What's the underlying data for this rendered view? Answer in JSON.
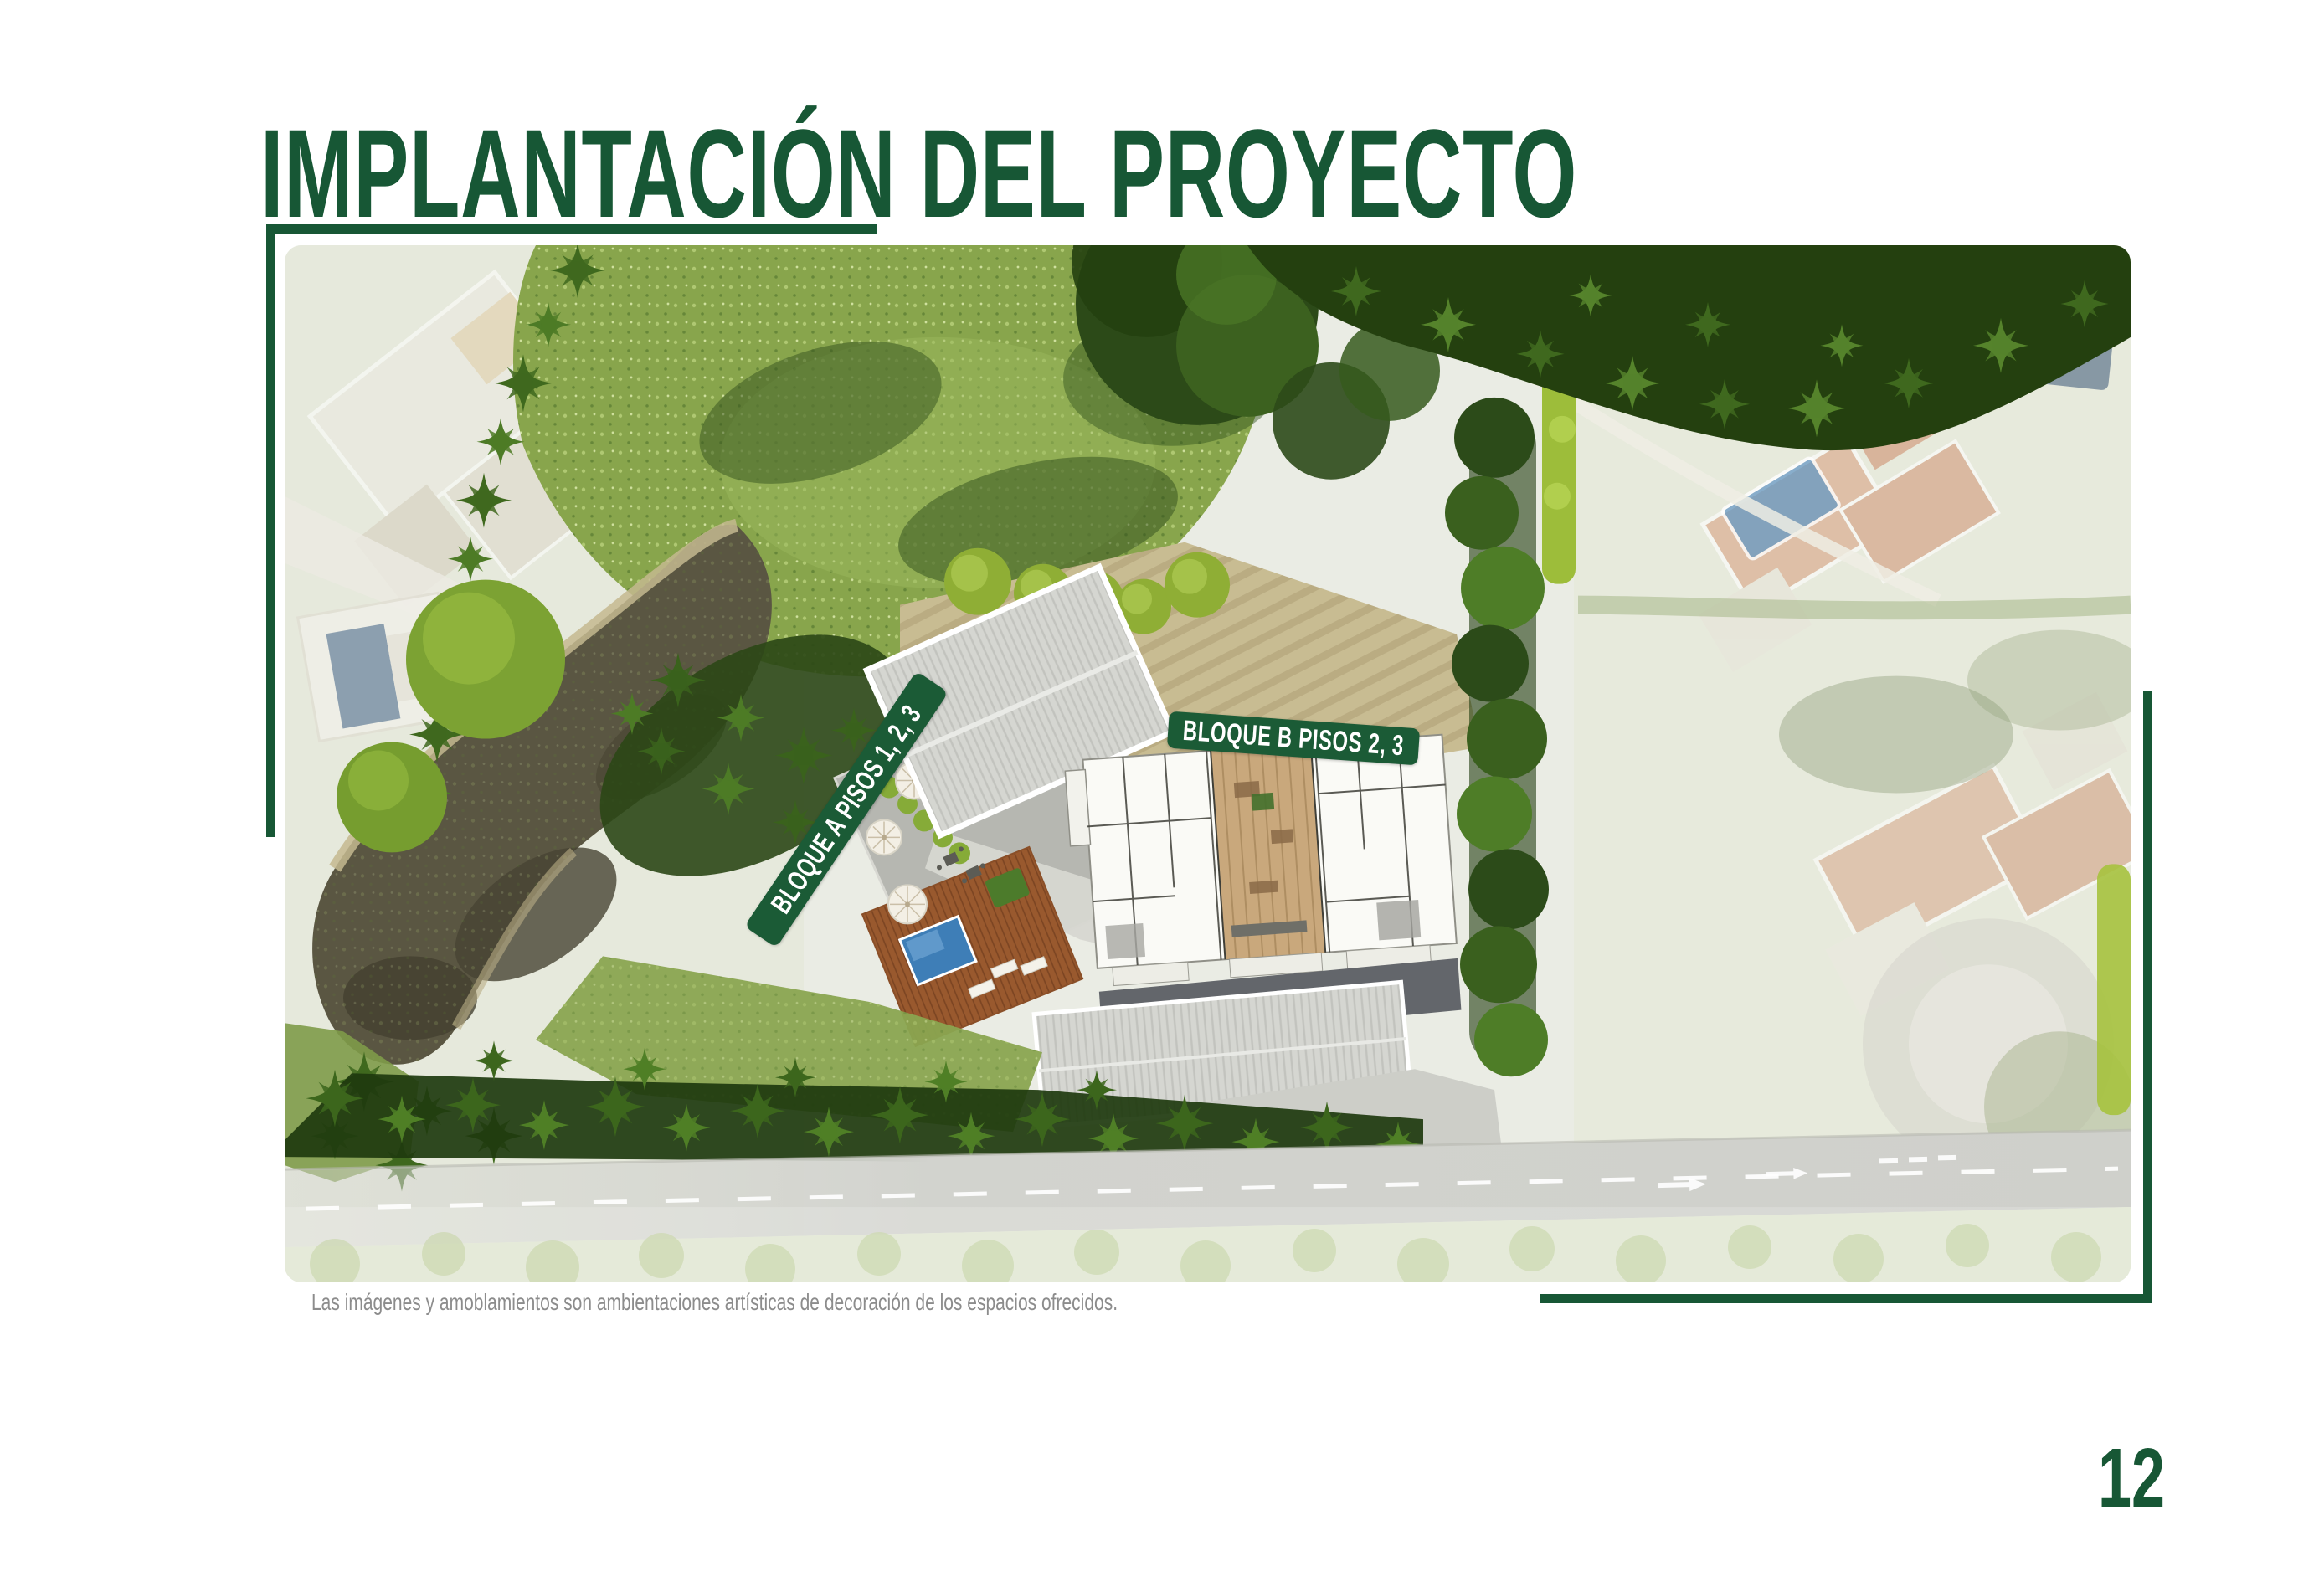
{
  "page": {
    "title": "IMPLANTACIÓN DEL PROYECTO",
    "page_number": "12",
    "disclaimer": "Las imágenes y amoblamientos son ambientaciones artísticas de decoración de los espacios ofrecidos.",
    "colors": {
      "accent_green": "#175735",
      "label_green": "#1B5B36",
      "label_text": "#FFFFFF",
      "disclaimer_gray": "#8C8C8C"
    }
  },
  "site_plan": {
    "labels": {
      "block_a": "BLOQUE A PISOS 1, 2, 3",
      "block_b": "BLOQUE B PISOS 2, 3"
    }
  }
}
